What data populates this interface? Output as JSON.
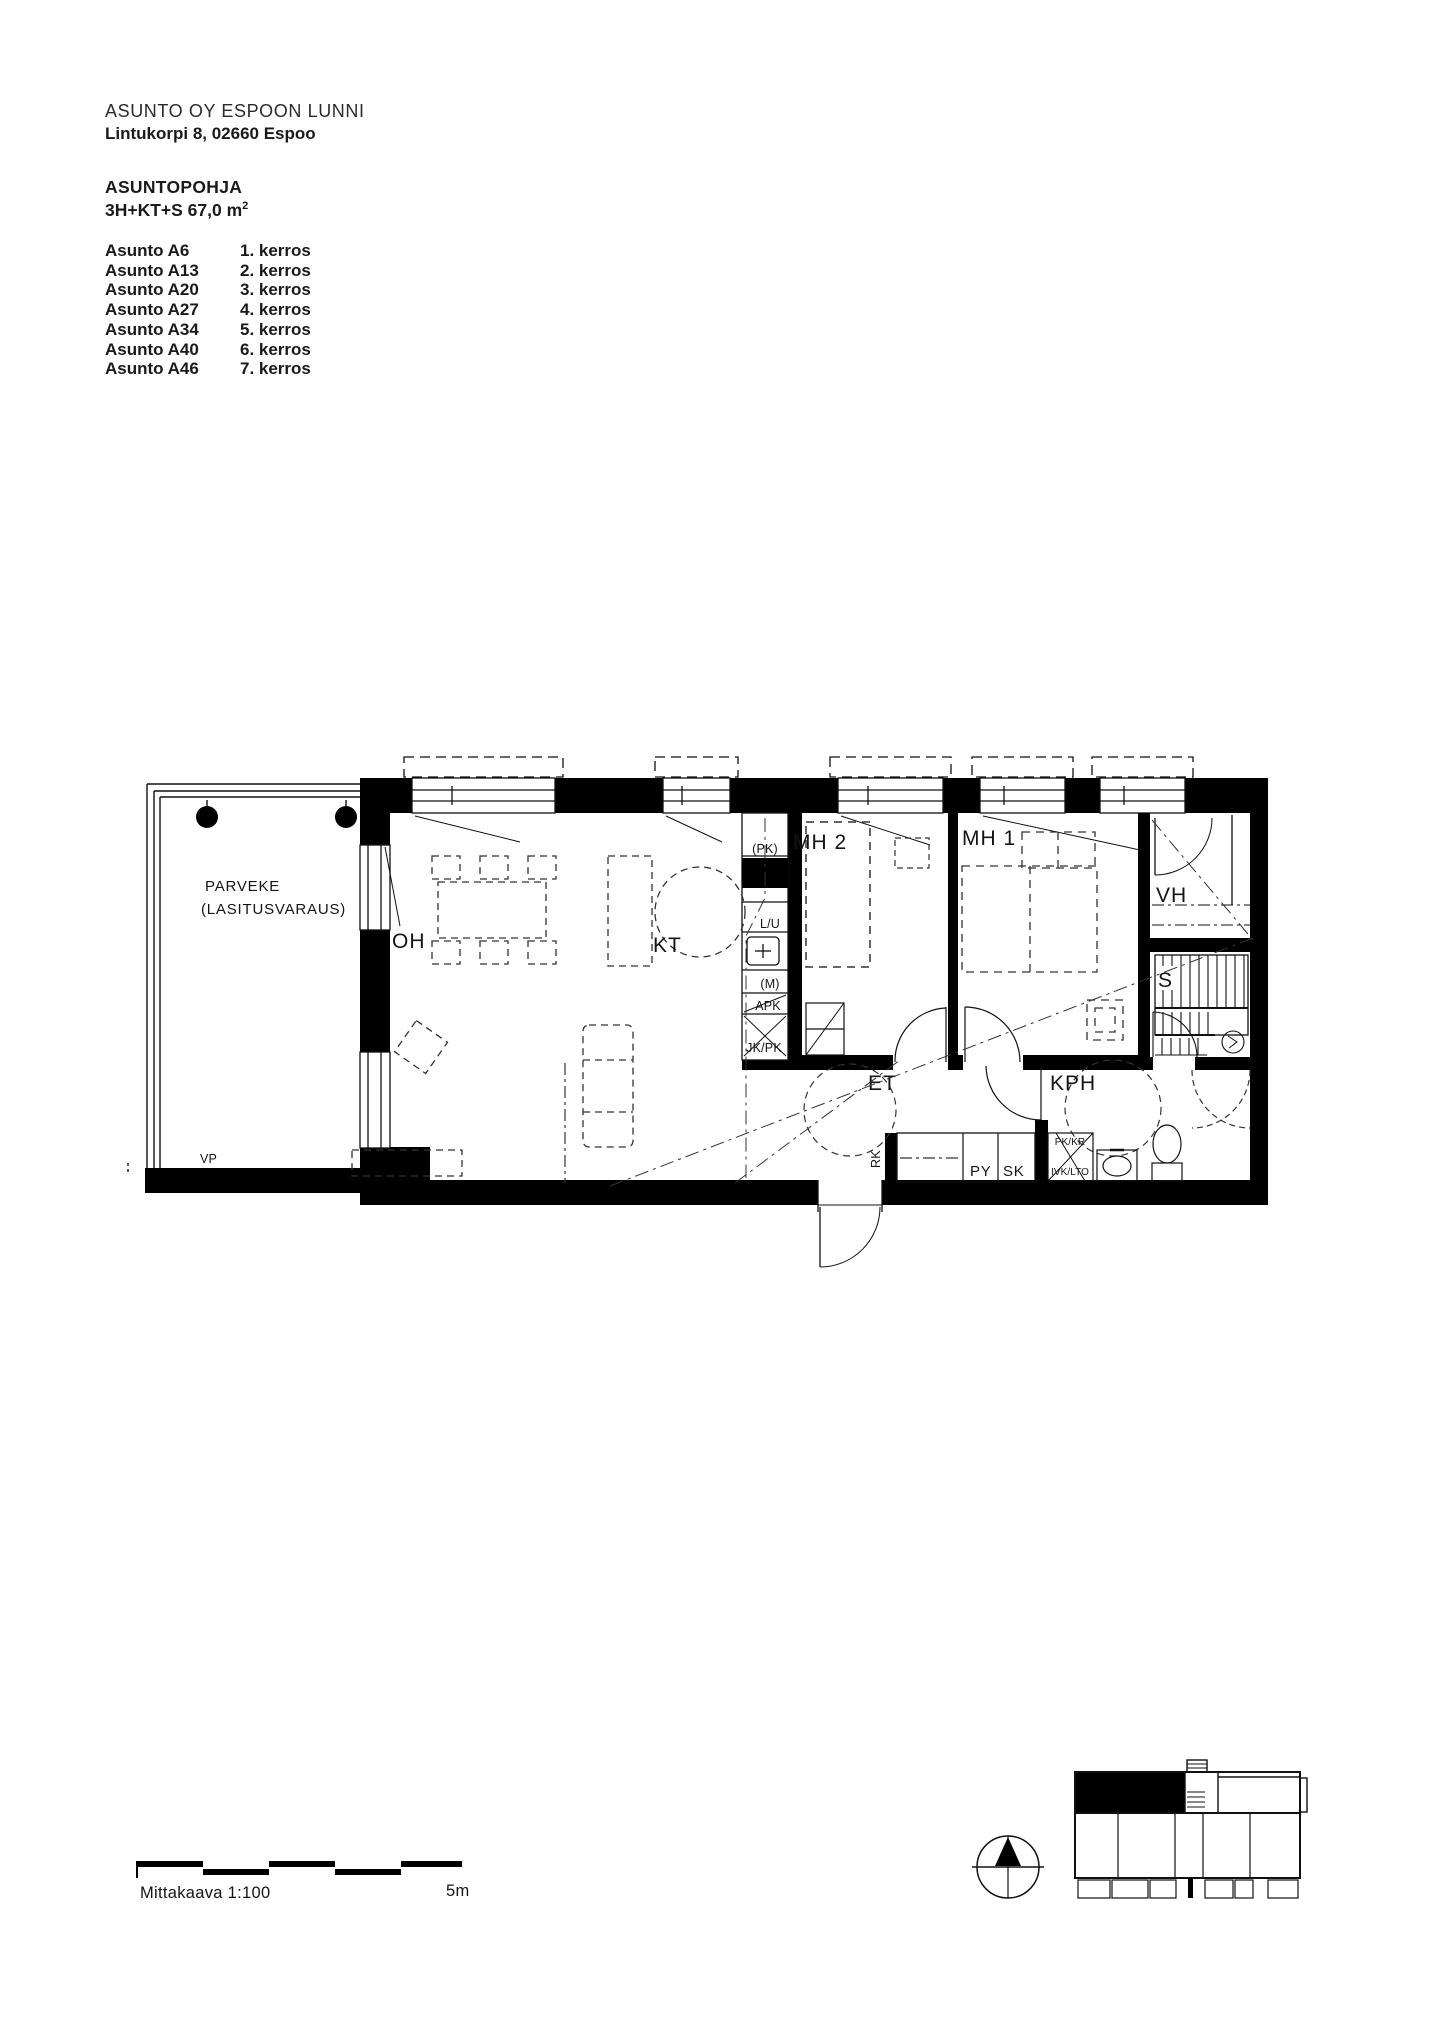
{
  "header": {
    "company": "ASUNTO OY ESPOON LUNNI",
    "address": "Lintukorpi 8, 02660 Espoo",
    "plan_title": "ASUNTOPOHJA",
    "apartment_spec_base": "3H+KT+S 67,0 m",
    "apartment_spec_sup": "2",
    "apartments": [
      {
        "unit": "Asunto A6",
        "floor": "1. kerros"
      },
      {
        "unit": "Asunto A13",
        "floor": "2. kerros"
      },
      {
        "unit": "Asunto A20",
        "floor": "3. kerros"
      },
      {
        "unit": "Asunto A27",
        "floor": "4. kerros"
      },
      {
        "unit": "Asunto A34",
        "floor": "5. kerros"
      },
      {
        "unit": "Asunto A40",
        "floor": "6. kerros"
      },
      {
        "unit": "Asunto A46",
        "floor": "7. kerros"
      }
    ]
  },
  "plan": {
    "rooms": {
      "balcony_line1": "PARVEKE",
      "balcony_line2": "(LASITUSVARAUS)",
      "vp": "VP",
      "oh": "OH",
      "kt": "KT",
      "mh2": "MH 2",
      "mh1": "MH 1",
      "vh": "VH",
      "sauna": "S",
      "et": "ET",
      "kph": "KPH"
    },
    "fixtures": {
      "pk": "(PK)",
      "lu": "L/U",
      "m": "(M)",
      "apk": "APK",
      "jkpk": "JK/PK",
      "rk": "RK",
      "py": "PY",
      "sk": "SK",
      "pkkr": "PK/KR",
      "ivklto": "IVK/LTO"
    }
  },
  "footer": {
    "scale_label": "Mittakaava 1:100",
    "scale_end": "5m"
  },
  "colors": {
    "ink": "#000000",
    "paper": "#ffffff"
  }
}
